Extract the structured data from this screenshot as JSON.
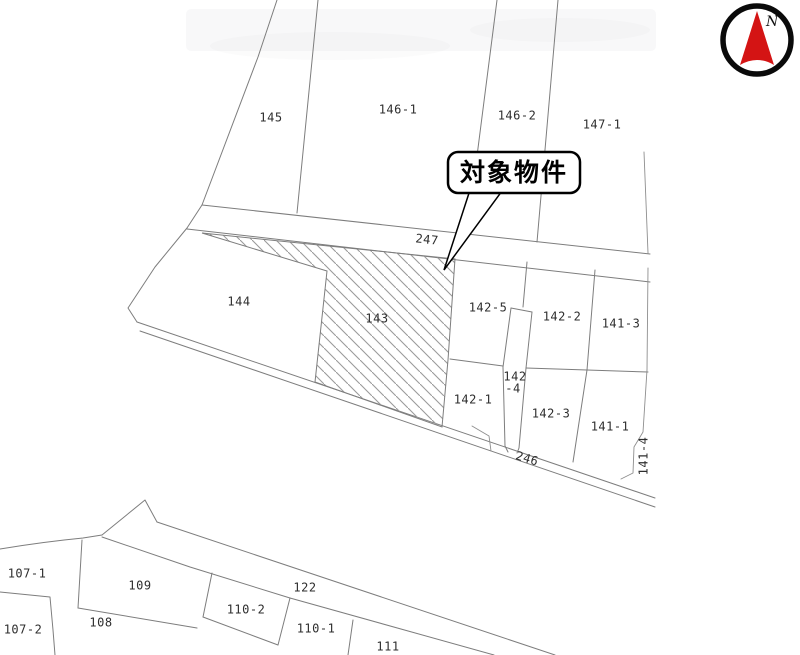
{
  "map": {
    "type": "cadastral-parcel-map",
    "callout": {
      "text": "対象物件"
    },
    "compass": {
      "north_label": "N",
      "arrow_color": "#d41414"
    },
    "colors": {
      "boundary_line": "#7d7d7d",
      "hatch_line": "#9a9a9a",
      "label_text": "#2e2e2e",
      "callout_border": "#000000",
      "background": "#ffffff"
    },
    "target_parcel": "143",
    "road_labels": [
      "247",
      "246",
      "122"
    ],
    "parcel_labels": [
      {
        "label": "145",
        "x": 271,
        "y": 118,
        "rot": 0
      },
      {
        "label": "146-1",
        "x": 398,
        "y": 110,
        "rot": 0
      },
      {
        "label": "146-2",
        "x": 517,
        "y": 116,
        "rot": 0
      },
      {
        "label": "147-1",
        "x": 602,
        "y": 125,
        "rot": 0
      },
      {
        "label": "247",
        "x": 427,
        "y": 240,
        "rot": 6
      },
      {
        "label": "144",
        "x": 239,
        "y": 302,
        "rot": 0
      },
      {
        "label": "143",
        "x": 377,
        "y": 319,
        "rot": 0
      },
      {
        "label": "142-5",
        "x": 488,
        "y": 308,
        "rot": 0
      },
      {
        "label": "142-2",
        "x": 562,
        "y": 317,
        "rot": 0
      },
      {
        "label": "141-3",
        "x": 621,
        "y": 324,
        "rot": 0
      },
      {
        "label": "142",
        "x": 515,
        "y": 377,
        "rot": 0
      },
      {
        "label": "-4",
        "x": 513,
        "y": 389,
        "rot": 0
      },
      {
        "label": "142-1",
        "x": 473,
        "y": 400,
        "rot": 0
      },
      {
        "label": "142-3",
        "x": 551,
        "y": 414,
        "rot": 0
      },
      {
        "label": "141-1",
        "x": 610,
        "y": 427,
        "rot": 0
      },
      {
        "label": "246",
        "x": 527,
        "y": 459,
        "rot": 17
      },
      {
        "label": "141-4",
        "x": 644,
        "y": 456,
        "rot": -90
      },
      {
        "label": "107-1",
        "x": 27,
        "y": 574,
        "rot": 0
      },
      {
        "label": "109",
        "x": 140,
        "y": 586,
        "rot": 0
      },
      {
        "label": "122",
        "x": 305,
        "y": 588,
        "rot": 0
      },
      {
        "label": "107-2",
        "x": 23,
        "y": 630,
        "rot": 0
      },
      {
        "label": "108",
        "x": 101,
        "y": 623,
        "rot": 0
      },
      {
        "label": "110-2",
        "x": 246,
        "y": 610,
        "rot": 0
      },
      {
        "label": "110-1",
        "x": 316,
        "y": 629,
        "rot": 0
      },
      {
        "label": "111",
        "x": 388,
        "y": 647,
        "rot": 0
      }
    ]
  }
}
